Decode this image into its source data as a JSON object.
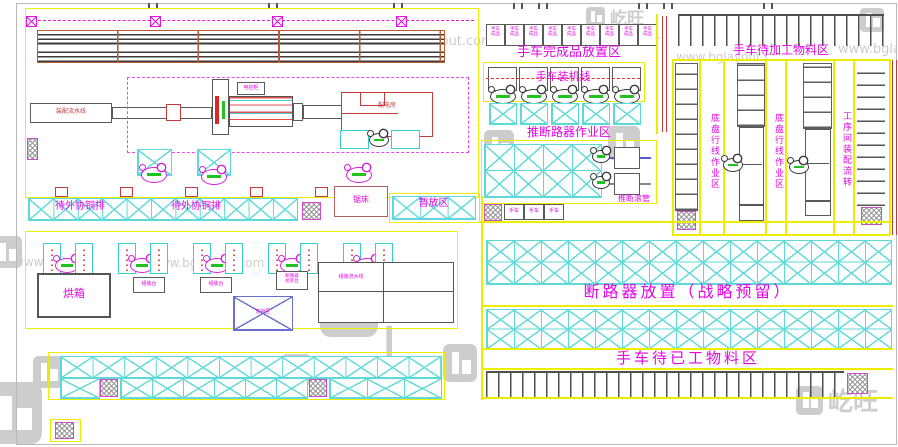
{
  "drawing": {
    "type": "factory-floor-plan",
    "watermark": {
      "url": "www.bglayout.com",
      "brand": "屹旺",
      "brand_initials": "BG"
    },
    "zones": {
      "finished_cart_area": "手车完成品放置区",
      "cart_install_line": "手车装机线",
      "breaker_push_area": "推断路器作业区",
      "breaker_roller_tube": "推断滚管",
      "cart_raw_material_area": "手车待加工物料区",
      "chassis_wiring_area_1": "底盘行线作业区",
      "chassis_wiring_area_2": "底盘行线作业区",
      "process_transfer_area": "工序间装配流转",
      "breaker_storage_area": "断路器放置（战略预留）",
      "cart_finished_material_area": "手车待已工物料区",
      "copper_busbar_wait_1": "待外协铜排",
      "copper_busbar_wait_2": "待外协铜排",
      "temp_storage_area": "暂放区"
    },
    "equipment": {
      "oven": "烘箱",
      "saw_machine": "锯床",
      "assembly_flow_line": "装配流水线",
      "power_room": "配电房",
      "control_cabinet": "电控柜",
      "assembly_bench": "组装台",
      "breaker_bench_line1": "断路器",
      "breaker_bench_line2": "组装台",
      "table_flow_line": "组装流水线",
      "hold_box": "暂存区",
      "cart_slot_line1": "手车",
      "cart_slot_line2": "成品",
      "cart_box": "手车"
    }
  }
}
